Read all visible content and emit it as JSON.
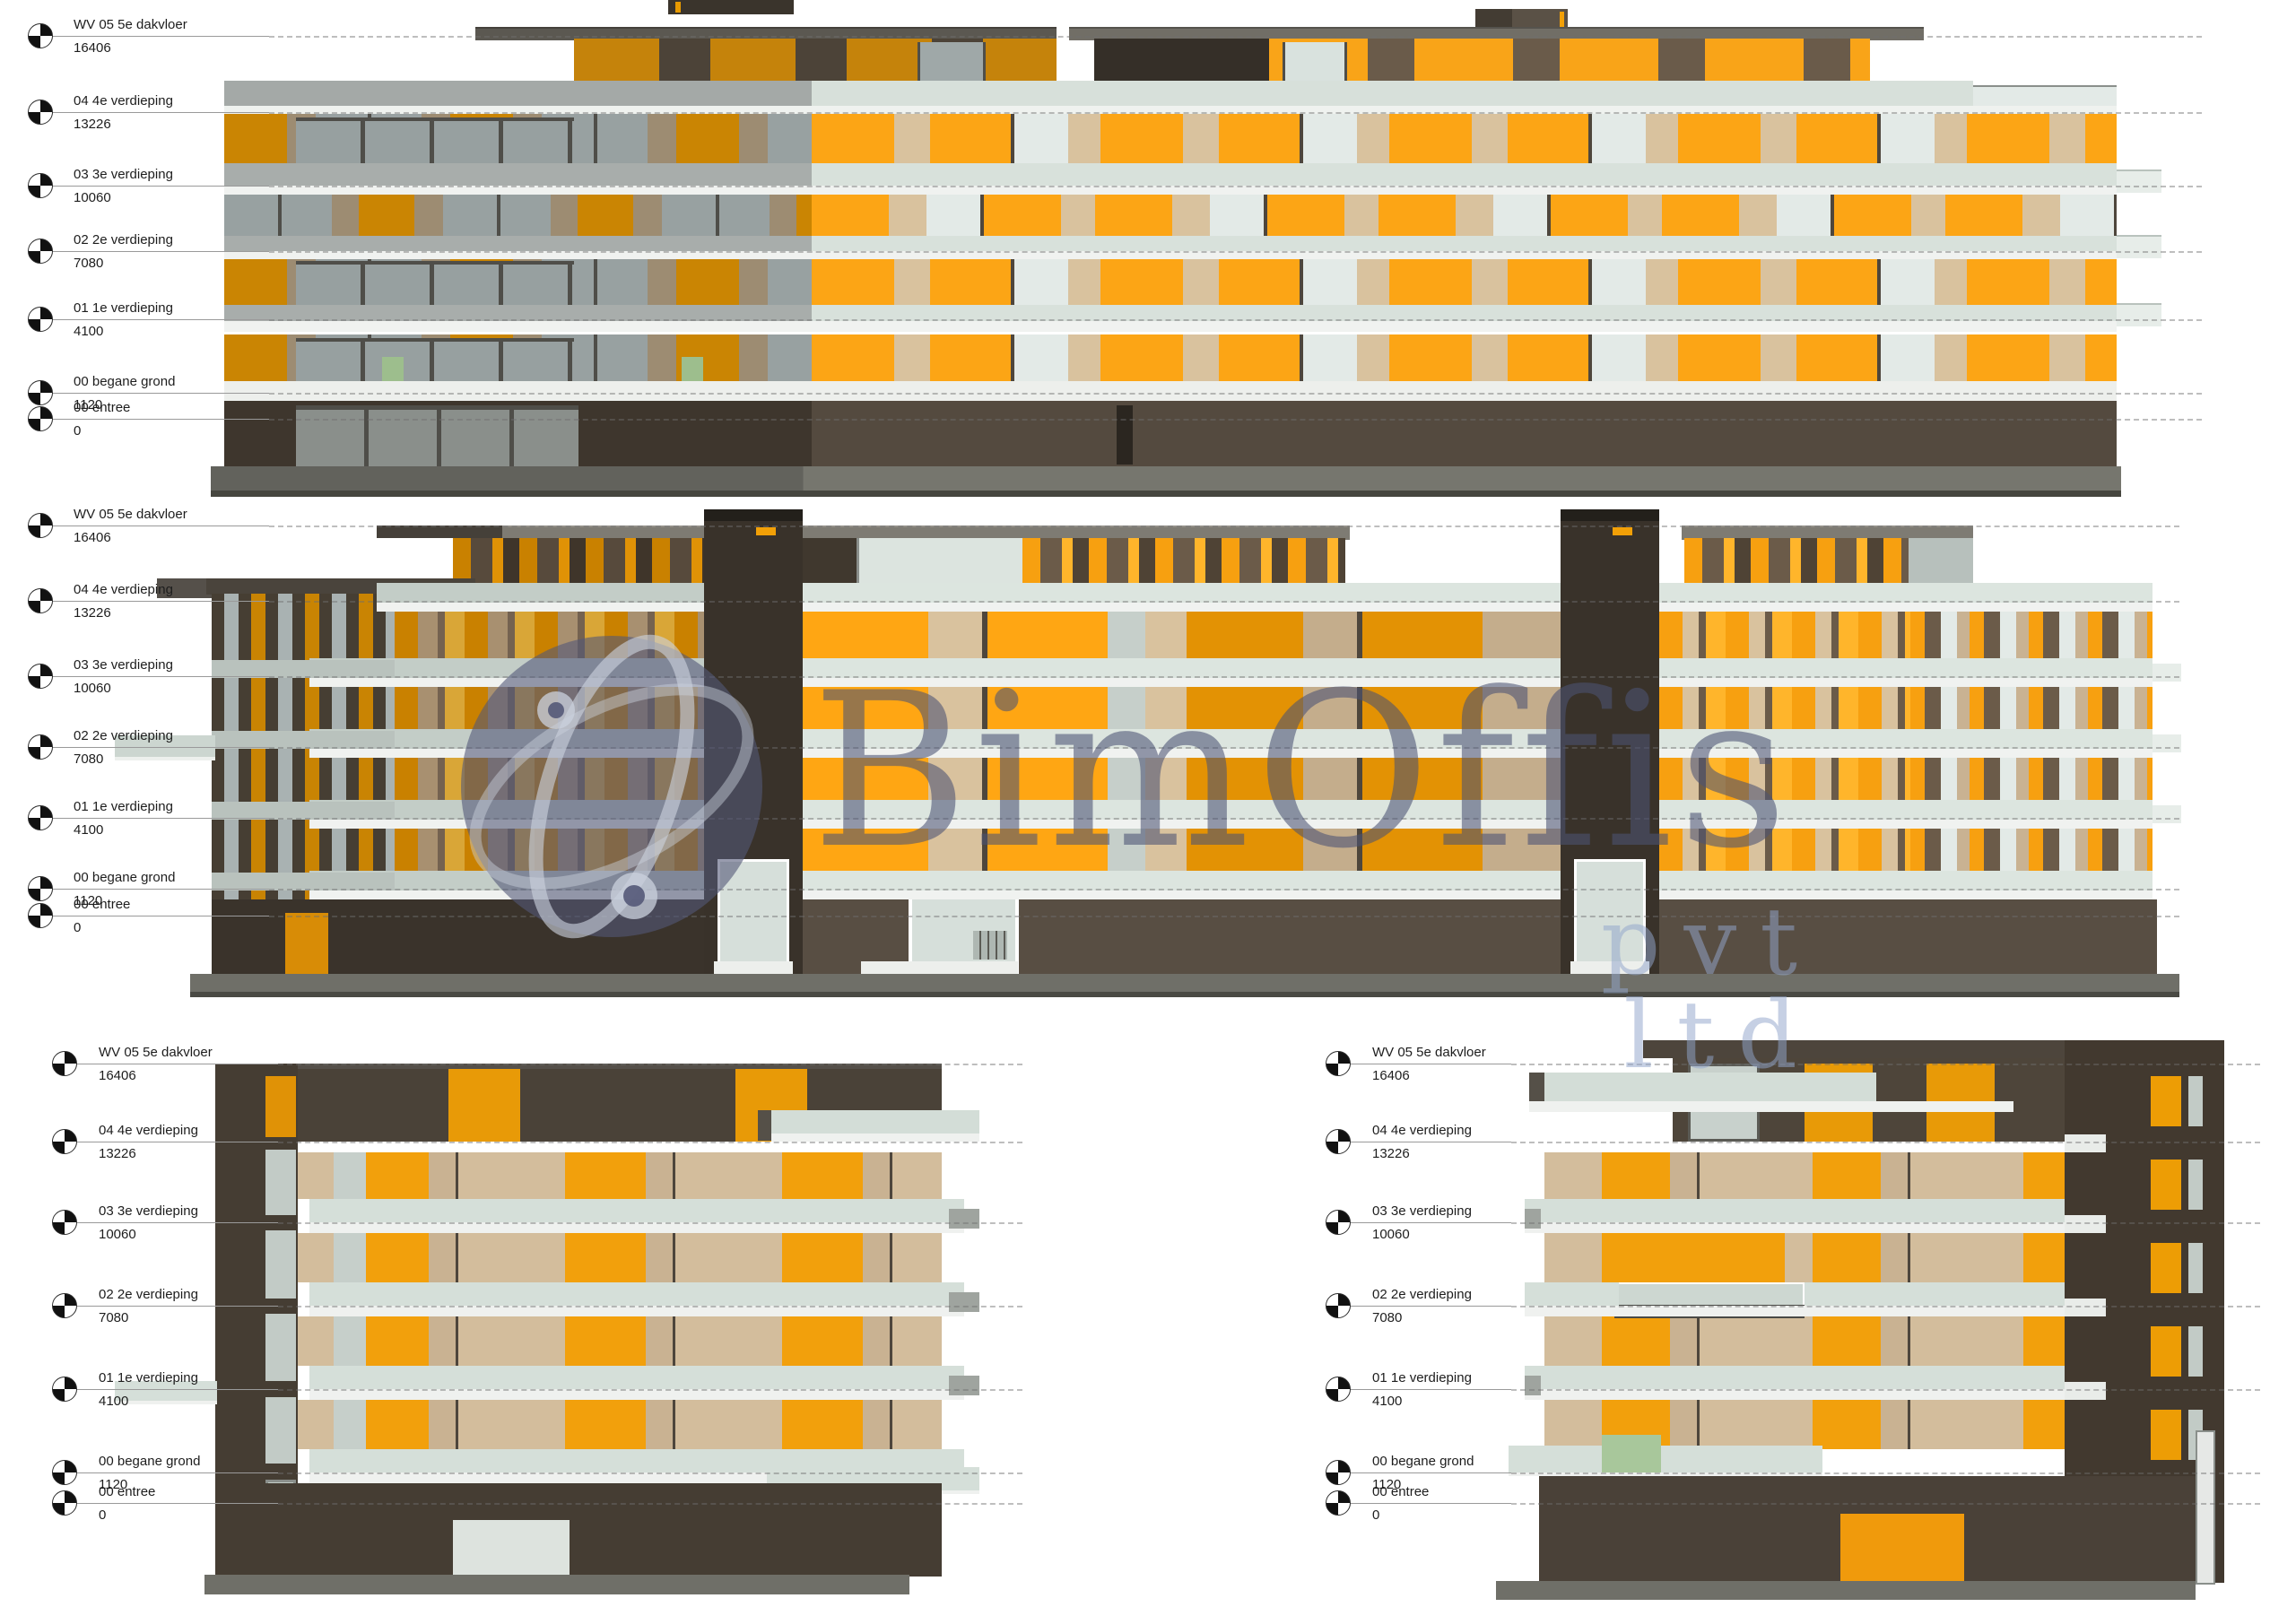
{
  "watermark": {
    "brand": "BimOffis",
    "suffix": "pvt ltd"
  },
  "levels": [
    {
      "name": "WV 05 5e dakvloer",
      "value": "16406"
    },
    {
      "name": "04 4e verdieping",
      "value": "13226"
    },
    {
      "name": "03 3e verdieping",
      "value": "10060"
    },
    {
      "name": "02 2e verdieping",
      "value": "7080"
    },
    {
      "name": "01 1e verdieping",
      "value": "4100"
    },
    {
      "name": "00 begane grond",
      "value": "1120"
    },
    {
      "name": "00 entree",
      "value": "0"
    }
  ],
  "colors": {
    "orange_lit": "#FCA515",
    "orange_shaded": "#C98403",
    "tan_lit": "#D9C29E",
    "tan_shaded": "#9D8C72",
    "slab_sage": "#D7E0DA",
    "slab_gray": "#A4A9A7",
    "slab_white": "#F0F2F0",
    "brown_dark": "#3E362D",
    "brown_mid": "#564C41",
    "glass_lit": "#E3EAE7",
    "glass_shaded": "#98A1A1",
    "roof_gray": "#716E66",
    "ground_gray": "#6F6F68",
    "green_accent": "#9DBE8D",
    "watermark_slate": "#4C5274"
  }
}
